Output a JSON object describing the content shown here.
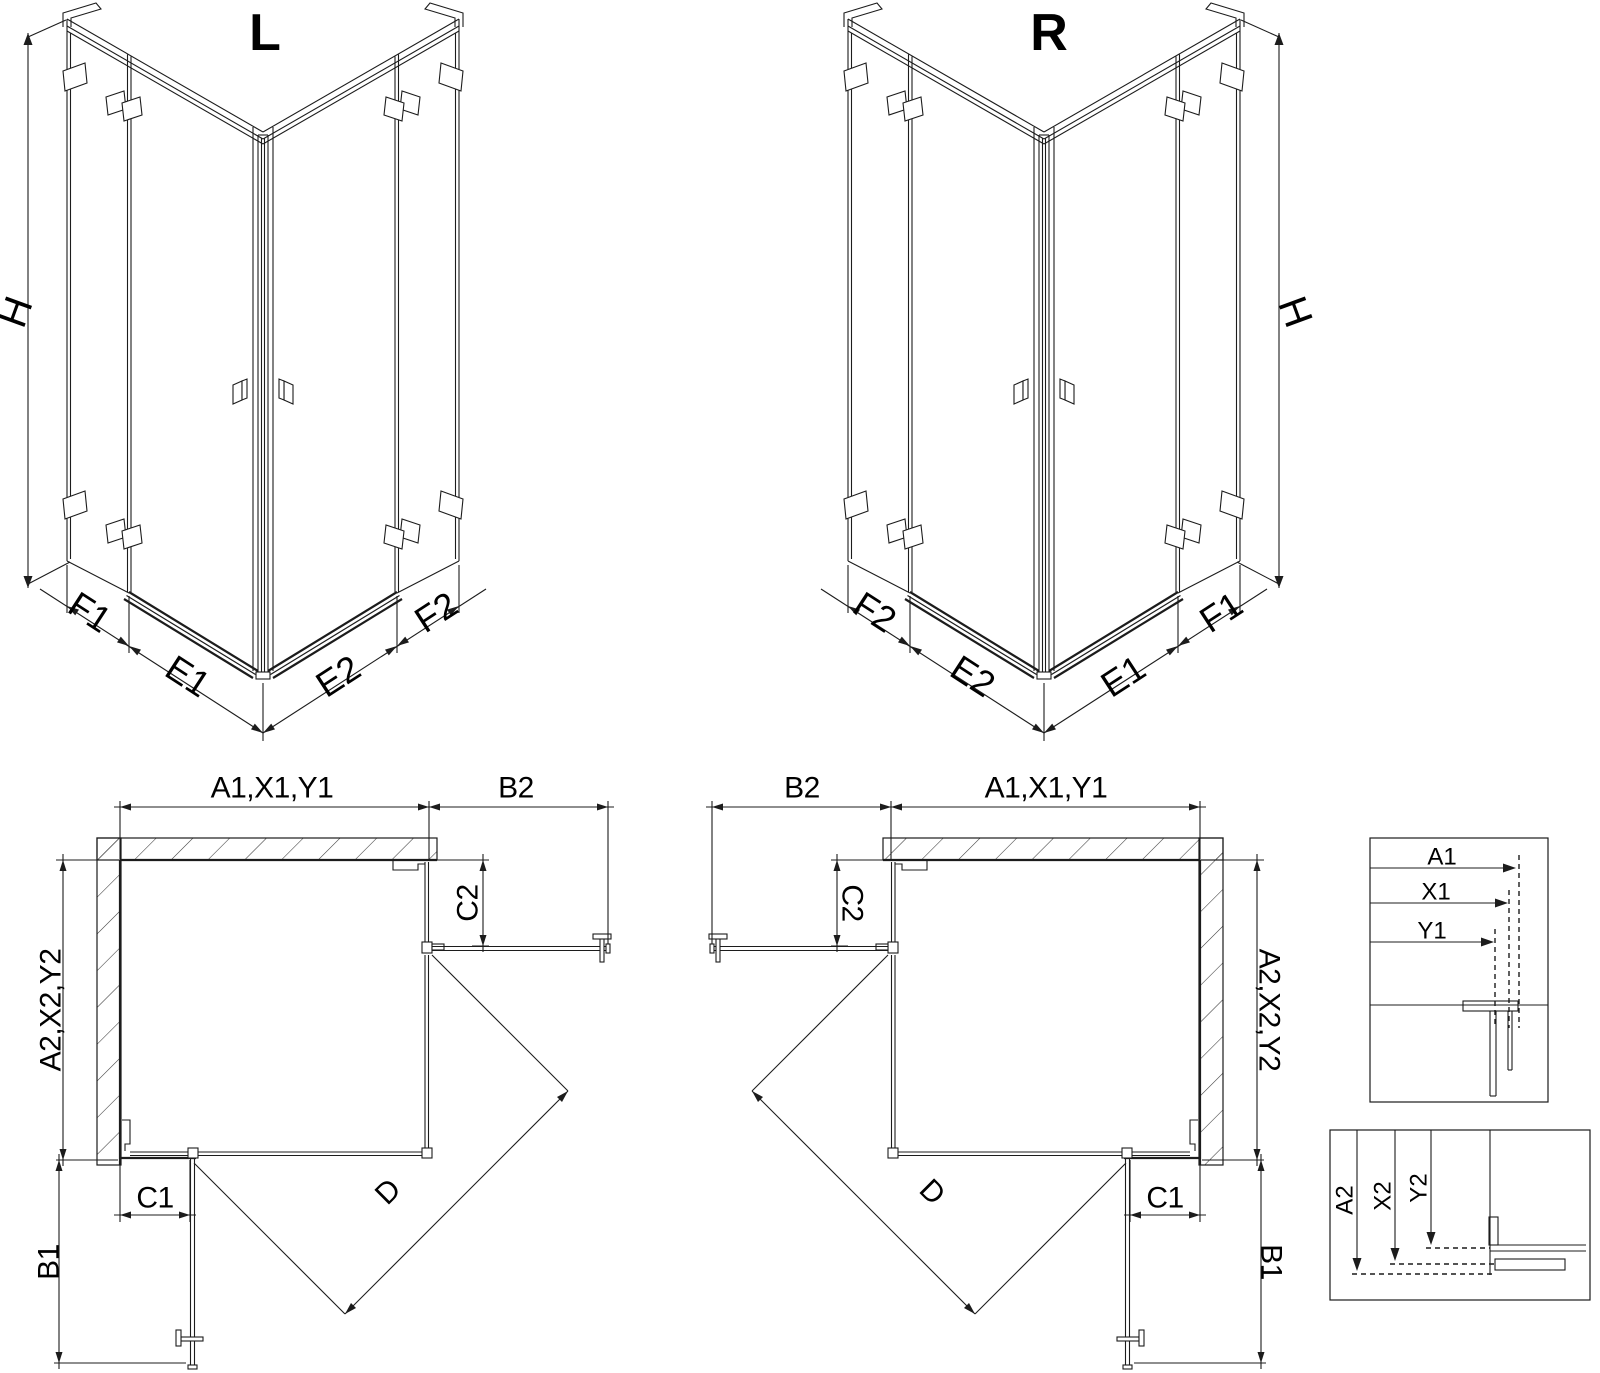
{
  "colors": {
    "ink": "#1c1c1c",
    "background": "#ffffff"
  },
  "iso_left": {
    "title": "L",
    "height_label": "H",
    "base_labels": {
      "f_outer": "F1",
      "e_door": "E1",
      "e_door_2": "E2",
      "f_outer_2": "F2"
    }
  },
  "iso_right": {
    "title": "R",
    "height_label": "H",
    "base_labels": {
      "f_outer": "F2",
      "e_door": "E2",
      "e_door_2": "E1",
      "f_outer_2": "F1"
    }
  },
  "plan_left": {
    "width_total": "A1,X1,Y1",
    "door_open_top": "B2",
    "depth_total": "A2,X2,Y2",
    "fixed_panel_side": "C2",
    "fixed_panel_bottom": "C1",
    "door_open_side": "B1",
    "entry_diagonal": "D"
  },
  "plan_right": {
    "width_total": "A1,X1,Y1",
    "door_open_top": "B2",
    "depth_total": "A2,X2,Y2",
    "fixed_panel_side": "C2",
    "fixed_panel_bottom": "C1",
    "door_open_side": "B1",
    "entry_diagonal": "D"
  },
  "detail_width": {
    "labels": [
      "A1",
      "X1",
      "Y1"
    ]
  },
  "detail_depth": {
    "labels": [
      "A2",
      "X2",
      "Y2"
    ]
  }
}
